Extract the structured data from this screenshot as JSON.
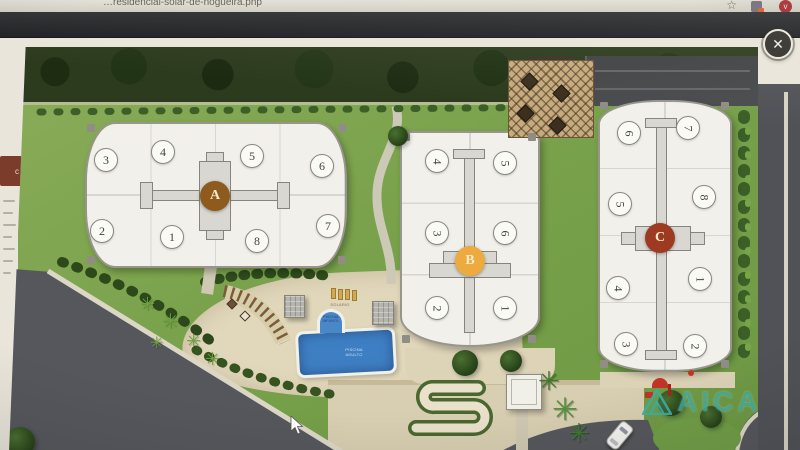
{
  "browser": {
    "url": "…residencial-solar-de-nogueira.php",
    "profile_initial": "v",
    "icons": {
      "bookmark": "☆"
    }
  },
  "lightbox": {
    "close_glyph": "✕"
  },
  "side_page": {
    "tab_label": "c"
  },
  "glyphs": {
    "palm": "✳"
  },
  "site_plan": {
    "buildings": {
      "a": {
        "label": "A",
        "badge_color": "#8e5a1d",
        "units": [
          "3",
          "4",
          "5",
          "6",
          "2",
          "1",
          "8",
          "7"
        ]
      },
      "b": {
        "label": "B",
        "badge_color": "#ecaa3f",
        "units": [
          "4",
          "5",
          "3",
          "6",
          "2",
          "1"
        ]
      },
      "c": {
        "label": "C",
        "badge_color": "#9e3a22",
        "units": [
          "6",
          "7",
          "5",
          "8",
          "4",
          "1",
          "3",
          "2"
        ]
      }
    },
    "pool": {
      "deck_label": "SOLARIO",
      "infant_line1": "PISCINA",
      "infant_line2": "INFANTIL",
      "adult_line1": "PISCINA",
      "adult_line2": "ADULTO"
    },
    "watermark": {
      "text": "AICA",
      "color": "#3fb0a4"
    }
  }
}
